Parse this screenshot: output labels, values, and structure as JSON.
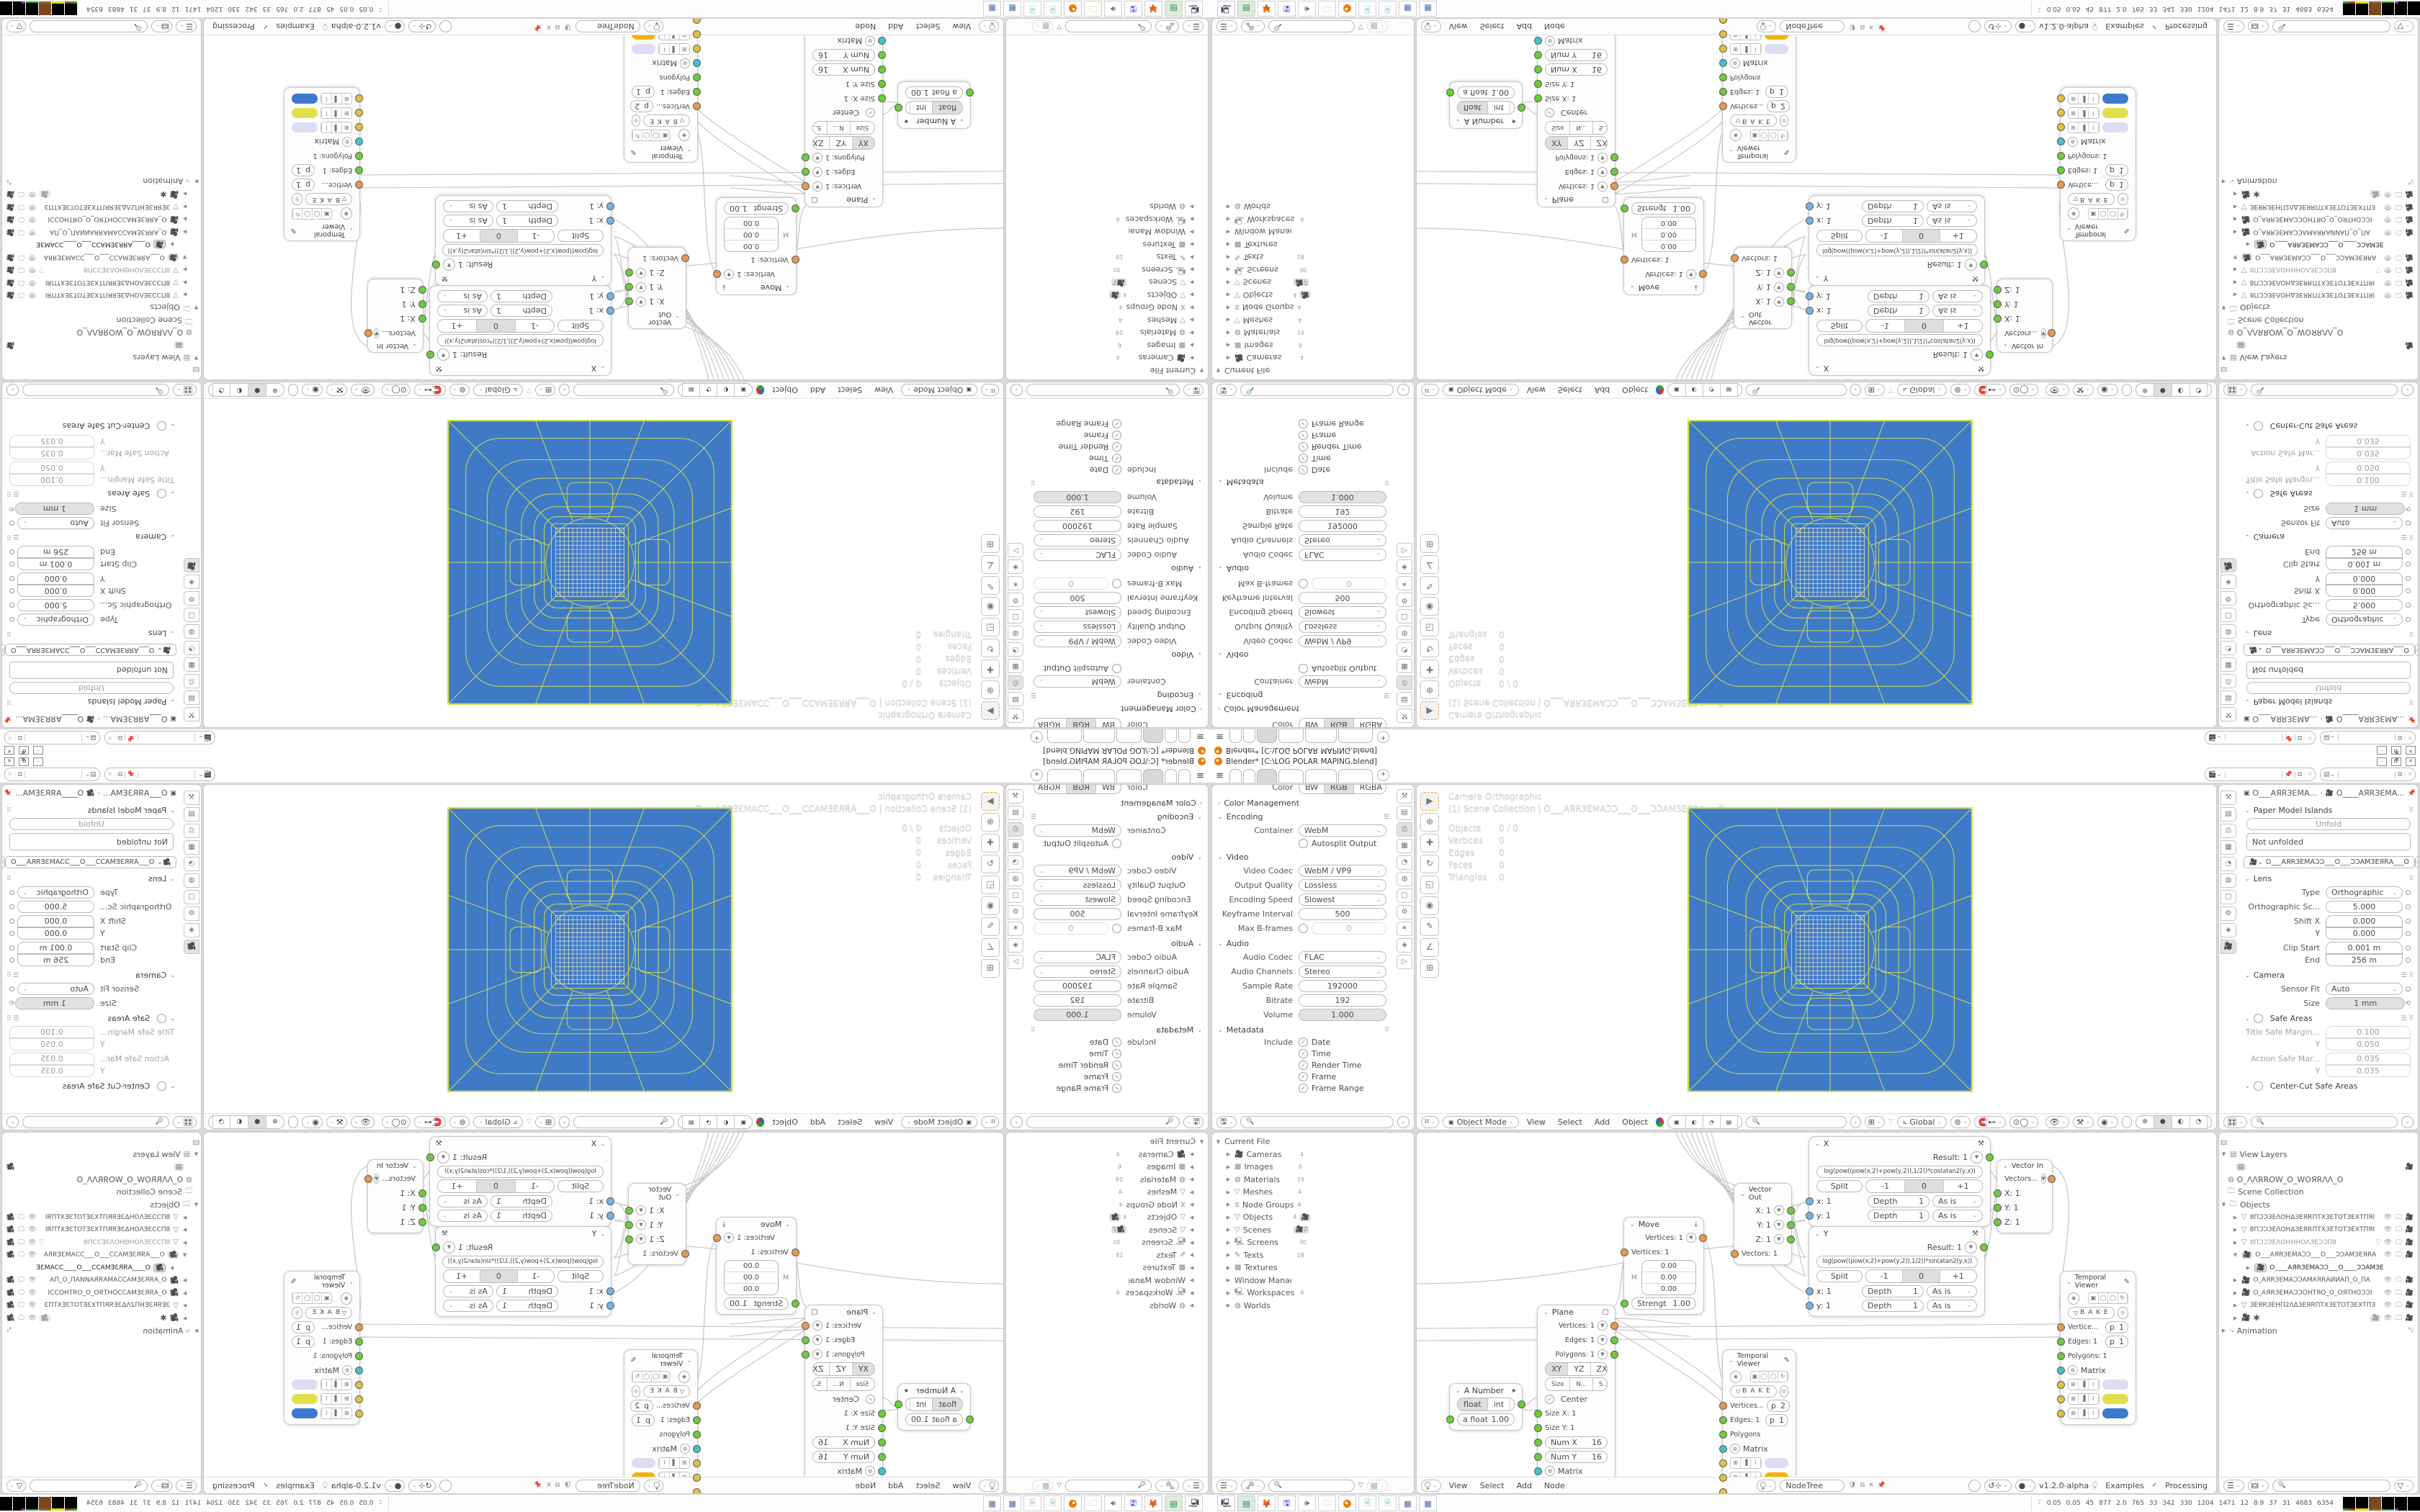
{
  "colors": {
    "plane_blue": "#3e7ac6",
    "wire_yellow": "#d2df52",
    "grid_pale": "#e9e9cf",
    "socket_green": "#6ecb3d",
    "socket_orange": "#e79a4e",
    "socket_blue": "#79b2e2",
    "socket_cyan": "#46c2c9",
    "socket_yellow": "#e2c23e",
    "swatch_lavender": "#dcdcf2",
    "swatch_lime": "#e2e04a",
    "swatch_amber": "#f0b400",
    "swatch_blue": "#3c7ad0",
    "active_tool_outline": "#e8a33d"
  },
  "window": {
    "title": "Blender* [C:\\LOG POLAR MAPING.blend]",
    "minimize": "–",
    "restore": "🗗",
    "close": "✕"
  },
  "topbar": {
    "hamburger": "≡",
    "add_tab": "+",
    "pin": "📌",
    "copy": "⧉",
    "close": "✕"
  },
  "props_out": {
    "color_label": "Color",
    "bw": "BW",
    "rgb": "RGB",
    "rgba": "RGBA",
    "color_mgmt": "Color Management",
    "encoding": "Encoding",
    "container_label": "Container",
    "container": "WebM",
    "autosplit": "Autosplit Output",
    "video": "Video",
    "video_codec_label": "Video Codec",
    "video_codec": "WebM / VP9",
    "quality_label": "Output Quality",
    "quality": "Lossless",
    "speed_label": "Encoding Speed",
    "speed": "Slowest",
    "keyframe_label": "Keyframe Interval",
    "keyframe": "500",
    "maxb_label": "Max B-frames",
    "maxb": "0",
    "audio": "Audio",
    "audio_codec_label": "Audio Codec",
    "audio_codec": "FLAC",
    "channels_label": "Audio Channels",
    "channels": "Stereo",
    "sample_label": "Sample Rate",
    "sample": "192000",
    "bitrate_label": "Bitrate",
    "bitrate": "192",
    "volume_label": "Volume",
    "volume": "1.000",
    "metadata": "Metadata",
    "include_label": "Include",
    "include": [
      "Date",
      "Time",
      "Render Time",
      "Frame",
      "Frame Range"
    ]
  },
  "viewport": {
    "overlay_line1": "Camera Orthographic",
    "overlay_line2": "(1) Scene Collection | О___АЯRЗЕМАƆƆ___О___ƆƆАМЗЕЯRА___О",
    "stats": [
      [
        "Objects",
        "0 / 0"
      ],
      [
        "Vertices",
        "0"
      ],
      [
        "Edges",
        "0"
      ],
      [
        "Faces",
        "0"
      ],
      [
        "Triangles",
        "0"
      ]
    ],
    "mode": "Object Mode",
    "menus": [
      "View",
      "Select",
      "Add",
      "Object"
    ],
    "orientation": "Global"
  },
  "props_cam": {
    "crumb1": "О___АЯRЗЕМА...",
    "crumb2": "О____АЯRЗЕМА...",
    "paper": "Paper Model Islands",
    "unfold": "Unfold",
    "not_unfolded": "Not unfolded",
    "cam_id": "О___АЯRЗЕМАƆƆ___О___ƆƆАМЗЕЯRА___О",
    "lens": "Lens",
    "type_label": "Type",
    "type": "Orthographic",
    "ortho_label": "Orthographic Sc...",
    "ortho": "5.000",
    "shiftx_label": "Shift X",
    "shiftx": "0.000",
    "shifty_label": "Y",
    "shifty": "0.000",
    "clip_label": "Clip Start",
    "clip": "0.001 m",
    "end_label": "End",
    "end": "256 m",
    "camera": "Camera",
    "fit_label": "Sensor Fit",
    "fit": "Auto",
    "size_label": "Size",
    "size": "1 mm",
    "safe": "Safe Areas",
    "tsm_label": "Title Safe Margin...",
    "tsm": "0.100",
    "tsy_label": "Y",
    "tsy": "0.050",
    "asm_label": "Action Safe Mar...",
    "asm": "0.035",
    "asy_label": "Y",
    "asy": "0.035",
    "centercut": "Center-Cut Safe Areas"
  },
  "blendfile": {
    "rows": [
      {
        "label": "Current File",
        "count": ""
      },
      {
        "label": "Cameras",
        "count": "4"
      },
      {
        "label": "Images",
        "count": "6"
      },
      {
        "label": "Materials",
        "count": "19"
      },
      {
        "label": "Meshes",
        "count": "4"
      },
      {
        "label": "Node Groups",
        "count": "4"
      },
      {
        "label": "Objects",
        "count": "4"
      },
      {
        "label": "Scenes",
        "count": ""
      },
      {
        "label": "Screens",
        "count": "30"
      },
      {
        "label": "Texts",
        "count": "18"
      },
      {
        "label": "Textures",
        "count": ""
      },
      {
        "label": "Window Managers",
        "count": ""
      },
      {
        "label": "Workspaces",
        "count": "6"
      },
      {
        "label": "Worlds",
        "count": ""
      }
    ]
  },
  "outliner": {
    "rows": [
      {
        "label": "View Layers"
      },
      {
        "label": ""
      },
      {
        "label": "О_ΛΛRROW_О_WОЯRΛΛ_О"
      },
      {
        "label": "Scene Collection"
      },
      {
        "label": "Objects"
      },
      {
        "label": "8ПƆƆЗЕΛОНΔЗЕЯRПТХЗЕТОТЗЕХТПЯI"
      },
      {
        "label": "8ПƆƆЗЕΛОНΔЗЕЯRПТХЗЕТОТЗЕХТПЯI"
      },
      {
        "label": "8ПƆƆЗЕΛОНΘНΟΛЗЕƆƆП8"
      },
      {
        "label": "О___АЯRЗЕМАƆƆ___О___ƆƆАМЗЕЯRА"
      },
      {
        "label": "О____АЯRЗЕМАƆƆ___О____ƆƆАМЗЕ"
      },
      {
        "label": "О_АЯRЗЕМАƆƆАМАЯRАИИАП_О_ПА"
      },
      {
        "label": "О_АЯRЗЕМАƆƆОНТЯО_О_ОЯТНОƆƆI"
      },
      {
        "label": "ЗЕЯRЗЕНП2ΛΔЗЕЯRПТХЗЕТОТЗЕХТПЗ"
      },
      {
        "label": "✱"
      },
      {
        "label": "Animation"
      }
    ]
  },
  "nodes": {
    "x": {
      "title": "X",
      "result": "Result: 1",
      "formula": "log(pow((pow(x,2)+pow(y,2)),1/2))*cos(atan2(y,x))",
      "split": "Split",
      "m1": "-1",
      "zero": "0",
      "p1": "+1",
      "in1": "x: 1",
      "in2": "y: 1",
      "depth": "Depth",
      "one": "1",
      "asis": "As is"
    },
    "y": {
      "title": "Y",
      "result": "Result: 1",
      "formula": "log(pow((pow(x,2)+pow(y,2)),1/2))*sin(atan2(y,x))",
      "split": "Split",
      "m1": "-1",
      "zero": "0",
      "p1": "+1",
      "in1": "x: 1",
      "in2": "y: 1",
      "depth": "Depth",
      "one": "1",
      "asis": "As is"
    },
    "vin": {
      "title": "Vector In",
      "vectors": "Vectors...",
      "x": "X: 1",
      "y": "Y: 1",
      "z": "Z: 1"
    },
    "vout": {
      "title": "Vector Out",
      "x": "X: 1",
      "y": "Y: 1",
      "z": "Z: 1",
      "vectors": "Vectors: 1"
    },
    "move": {
      "title": "Move",
      "out": "Vertices: 1",
      "in": "Vertices: 1",
      "v1": "0.00",
      "v2": "0.00",
      "v3": "0.00",
      "m": "M",
      "strength_label": "Strengt",
      "strength": "1.00"
    },
    "plane": {
      "title": "Plane",
      "vertices": "Vertices: 1",
      "edges": "Edges: 1",
      "polygons": "Polygons: 1",
      "xy": "XY",
      "yz": "YZ",
      "zx": "ZX",
      "size": "Size",
      "n": "N...",
      "s": "S...",
      "si": "Si...",
      "center": "Center",
      "sizex": "Size X: 1",
      "sizey": "Size Y: 1",
      "numx_label": "Num X",
      "numx": "16",
      "numy_label": "Num Y",
      "numy": "16",
      "matrix": "Matrix"
    },
    "anumber": {
      "title": "A Number",
      "float": "float",
      "int": "int",
      "afloat_label": "a float",
      "afloat": "1.00"
    },
    "tv1": {
      "title": "Temporal Viewer",
      "bake": "B A K E",
      "vertices": "Vertice...",
      "vtag": "p",
      "vnum": "1",
      "edges": "Edges: 1",
      "etag": "p",
      "enum": "1",
      "polygons": "Polygons: 1",
      "matrix": "Matrix"
    },
    "tv2": {
      "title": "Temporal Viewer",
      "bake": "B A K E",
      "vertices": "Vertices...",
      "vtag": "p",
      "vnum": "2",
      "edges": "Edges: 1",
      "etag": "p",
      "enum": "1",
      "polygons": "Polygons",
      "matrix": "Matrix"
    },
    "footer": {
      "view": "View",
      "select": "Select",
      "add": "Add",
      "node": "Node",
      "nodetree": "NodeTree",
      "version": "v1.2.0-alpha",
      "examples": "Examples",
      "processing": "Processing"
    }
  },
  "taskbar": {
    "numbers": [
      "0.05",
      "0.05",
      "45",
      "877",
      "2.0",
      "765",
      "33",
      "342",
      "330",
      "1204",
      "1471",
      "12",
      "8.9",
      "37",
      "31",
      "4683",
      "6354"
    ],
    "icons": [
      "system-monitor",
      "media-player",
      "firefox",
      "floppy-64",
      "speaker",
      "folder",
      "blender",
      "notepad",
      "notepad",
      "calculator",
      "calculator"
    ]
  }
}
